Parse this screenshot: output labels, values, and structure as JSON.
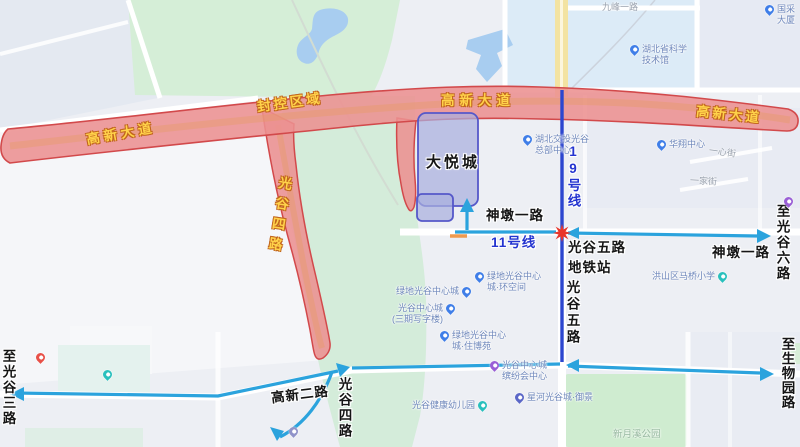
{
  "lockdown": {
    "zone_label": "封控区域",
    "gaoxin_avenue": "高新大道",
    "guanggu_4th_label": "光谷四路"
  },
  "metro": {
    "line_19": "19号线",
    "line_11": "11号线"
  },
  "roads": {
    "shendun_1st": "神墩一路",
    "guanggu_5th": "光谷五路",
    "guanggu_5th_station": "光谷五路\n地铁站",
    "gaoxin_2nd": "高新二路",
    "guanggu_4th": "光谷四路",
    "to_guanggu_3rd": "至光谷三路",
    "to_guanggu_6th": "至光谷六路",
    "to_biopark_road": "至生物园路",
    "jiufeng_1st": "九峰一路",
    "yixin_street": "一心街",
    "yijia_street": "一家街"
  },
  "buildings": {
    "joy_city": "大悦城"
  },
  "parks": {
    "xinyuexi": "新月溪公园"
  },
  "pois": [
    {
      "label": "湖北省科学\n技术馆",
      "pin_color": "#3f7ee8"
    },
    {
      "label": "国采大厦",
      "pin_color": "#3f7ee8"
    },
    {
      "label": "湖北交投光谷\n总部中心",
      "pin_color": "#3f7ee8"
    },
    {
      "label": "华翔中心",
      "pin_color": "#3f7ee8"
    },
    {
      "label": "洪山区马桥小学",
      "pin_color": "#29c0bd"
    },
    {
      "label": "绿地光谷中心\n城·环空间",
      "pin_color": "#3f7ee8"
    },
    {
      "label": "绿地光谷中心城",
      "pin_color": "#3f7ee8"
    },
    {
      "label": "光谷中心城\n(三期写字楼)",
      "pin_color": "#3f7ee8"
    },
    {
      "label": "绿地光谷中心\n城·住博苑",
      "pin_color": "#3f7ee8"
    },
    {
      "label": "光谷中心城\n缤纷会中心",
      "pin_color": "#9a5fd6"
    },
    {
      "label": "星河光谷城·御景",
      "pin_color": "#5b67c7"
    },
    {
      "label": "光谷健康幼儿园",
      "pin_color": "#29c0bd"
    }
  ],
  "map_colors": {
    "lockdown_fill": "#ec9191",
    "lockdown_border": "#d2494b",
    "zone_label_yellow": "#ffd24a",
    "metro_line_blue": "#2c46cf",
    "direction_arrow_cyan": "#2ba3dd",
    "station_marker_red": "#e8362a",
    "building_fill": "#a9aede",
    "building_border": "#5558c9",
    "park_green": "#d5eed7",
    "water_blue": "#a8cdf0",
    "construction_tick_orange": "#ef9a4e"
  }
}
